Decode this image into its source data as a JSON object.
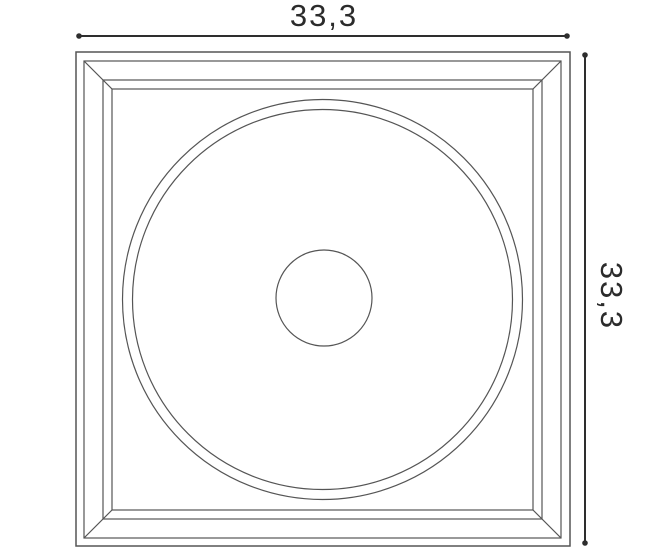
{
  "drawing": {
    "type": "technical-dimension-drawing",
    "subject": "square panel with mitered frame, concentric ring and center circle",
    "width_label": "33,3",
    "height_label": "33,3",
    "line_color": "#555555",
    "outer_edge_color": "#4a4a4a",
    "dimension_color": "#2e2e2e",
    "text_color": "#2b2b2b",
    "background_color": "#ffffff"
  }
}
